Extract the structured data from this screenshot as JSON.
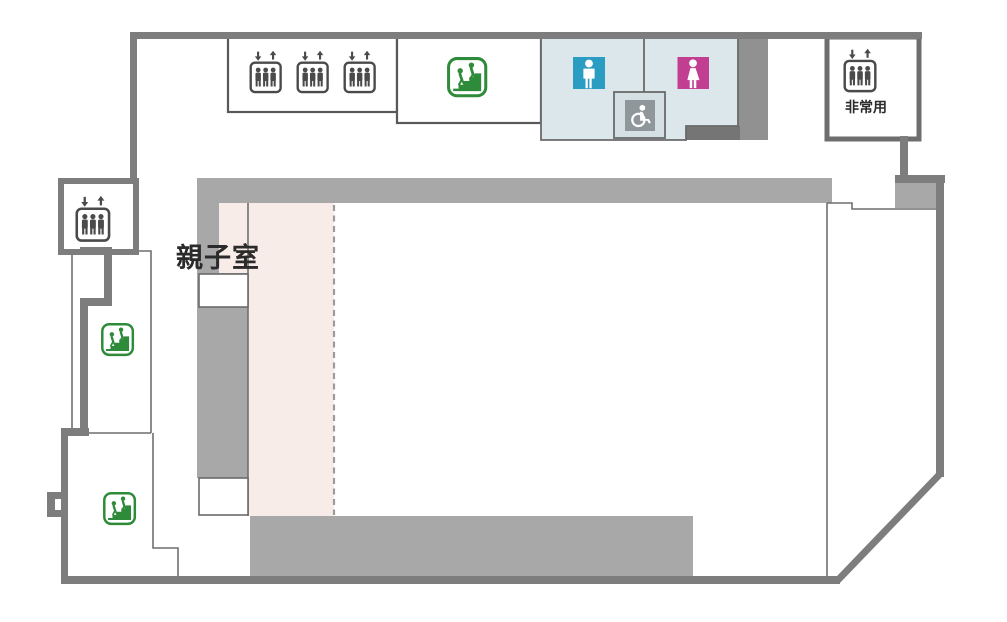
{
  "page": {
    "type": "station-floor-map",
    "background": "#ffffff"
  },
  "labels": {
    "parent_child_room": "親子室",
    "emergency_elevator": "非常用"
  },
  "colors": {
    "wall": "#7d7d7d",
    "wallDark": "#6e6e6e",
    "outline": "#6a6a6a",
    "boxOutline": "#595959",
    "thinLine": "#6f6f6f",
    "bandGray": "#a8a8a8",
    "blockGray": "#919191",
    "stepGray": "#757575",
    "restroomBg": "#dce7eb",
    "wheelchairBoxBg": "#d4e0e4",
    "mens": "#2b9cc2",
    "womens": "#c23e90",
    "accessible": "#8f979b",
    "stairsGreen": "#2e8b3a",
    "elevatorDark": "#4a4a4a",
    "roomPink": "#f8ece8",
    "dashLine": "#9b9b9b",
    "labelText": "#2b2b2b"
  },
  "icons": {
    "elevator": "elevator-icon",
    "stairs": "stairs-icon",
    "mens_restroom": "mens-restroom-icon",
    "womens_restroom": "womens-restroom-icon",
    "wheelchair_accessible": "wheelchair-accessible-icon"
  }
}
